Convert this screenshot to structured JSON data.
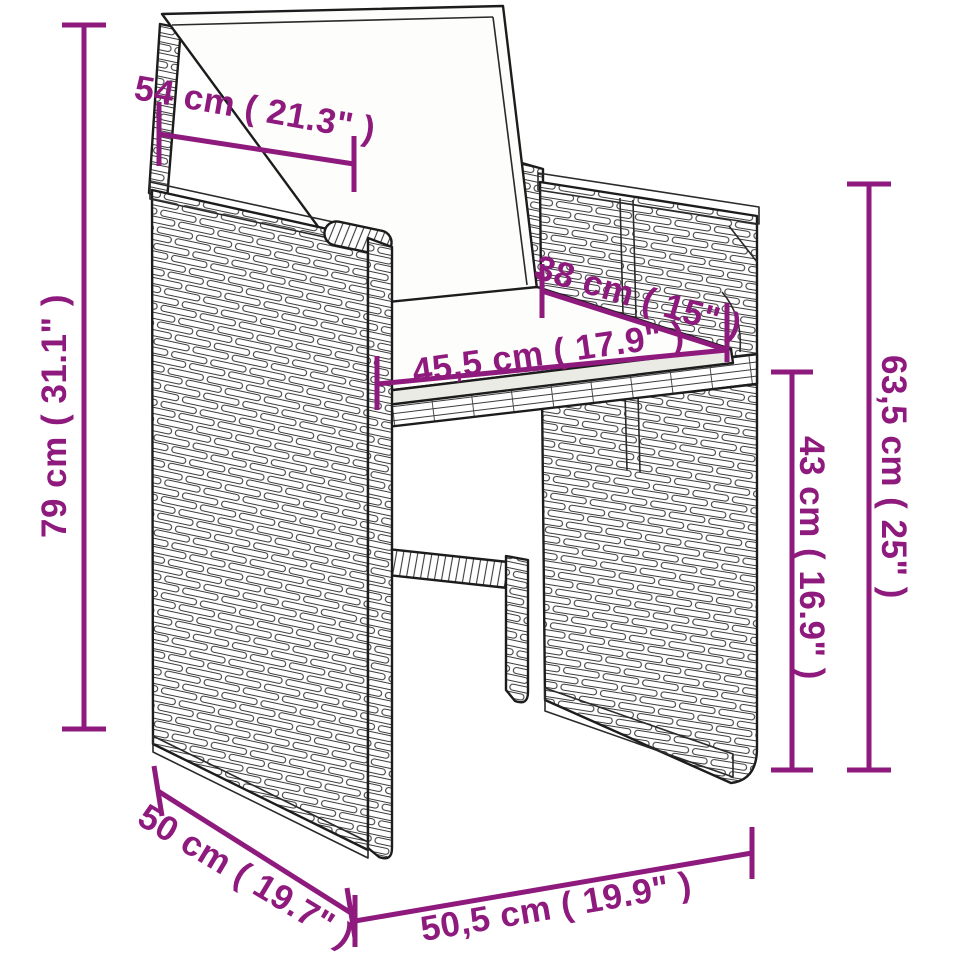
{
  "page": {
    "background_color": "#ffffff"
  },
  "diagram": {
    "subject": "poly-rattan-garden-chair-with-cushions",
    "accent_color": "#8e1a7d",
    "line_color": "#1c1c1c",
    "dimensions": [
      {
        "id": "backrest-width",
        "label": "54 cm ( 21.3\" )",
        "cm": "54",
        "inches": "21.3"
      },
      {
        "id": "total-height",
        "label": "79 cm ( 31.1\" )",
        "cm": "79",
        "inches": "31.1"
      },
      {
        "id": "seat-depth",
        "label": "38 cm ( 15\" )",
        "cm": "38",
        "inches": "15"
      },
      {
        "id": "seat-width",
        "label": "45,5 cm ( 17.9\" )",
        "cm": "45,5",
        "inches": "17.9"
      },
      {
        "id": "backrest-height",
        "label": "63,5 cm ( 25\" )",
        "cm": "63,5",
        "inches": "25"
      },
      {
        "id": "seat-height",
        "label": "43 cm ( 16.9\" )",
        "cm": "43",
        "inches": "16.9"
      },
      {
        "id": "base-depth",
        "label": "50 cm ( 19.7\" )",
        "cm": "50",
        "inches": "19.7"
      },
      {
        "id": "base-width",
        "label": "50,5 cm ( 19.9\" )",
        "cm": "50,5",
        "inches": "19.9"
      }
    ]
  }
}
